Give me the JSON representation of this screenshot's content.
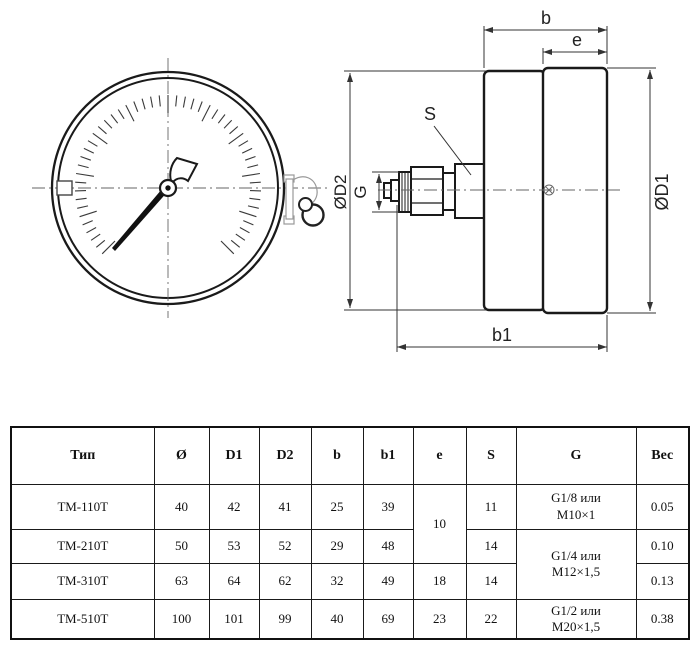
{
  "colors": {
    "ink": "#1a1a1a",
    "dim_line": "#333333",
    "center_line": "#666666"
  },
  "drawing": {
    "labels": {
      "b": "b",
      "e": "e",
      "s": "S",
      "g": "G",
      "d2": "ØD2",
      "d1": "ØD1",
      "b1": "b1"
    }
  },
  "table": {
    "headers": [
      "Тип",
      "Ø",
      "D1",
      "D2",
      "b",
      "b1",
      "e",
      "S",
      "G",
      "Вес"
    ],
    "rows": [
      {
        "type": "ТМ-110Т",
        "dia": "40",
        "d1": "42",
        "d2": "41",
        "b": "25",
        "b1": "39",
        "e": "10",
        "s": "11",
        "g": "G1/8 или\nМ10×1",
        "weight": "0.05"
      },
      {
        "type": "ТМ-210Т",
        "dia": "50",
        "d1": "53",
        "d2": "52",
        "b": "29",
        "b1": "48",
        "s": "14",
        "g": "G1/4 или\nМ12×1,5",
        "weight": "0.10"
      },
      {
        "type": "ТМ-310Т",
        "dia": "63",
        "d1": "64",
        "d2": "62",
        "b": "32",
        "b1": "49",
        "e": "18",
        "s": "14",
        "weight": "0.13"
      },
      {
        "type": "ТМ-510Т",
        "dia": "100",
        "d1": "101",
        "d2": "99",
        "b": "40",
        "b1": "69",
        "e": "23",
        "s": "22",
        "g": "G1/2 или\nМ20×1,5",
        "weight": "0.38"
      }
    ]
  }
}
